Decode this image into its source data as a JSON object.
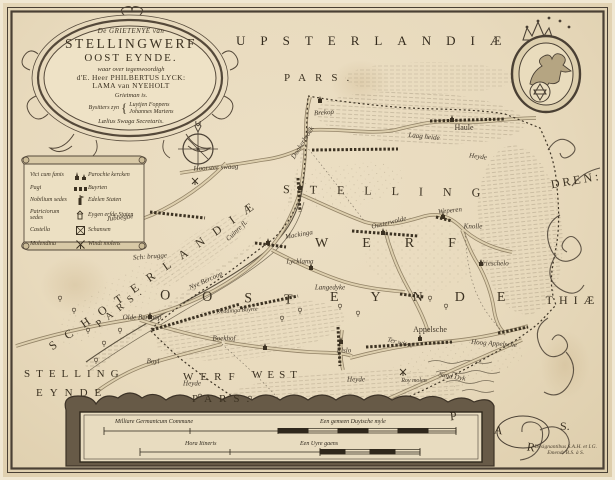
{
  "title_cartouche": {
    "line1": "De GRIETENYE van",
    "line2": "STELLINGWERF",
    "line3": "OOST EYNDE.",
    "line4": "waar over tegenwoordigh",
    "line5": "d'E. Heer PHILBERTUS LYCK:",
    "line6": "LAMA van NYEHOLT",
    "line7": "Grietman is.",
    "bysitters_label": "Bysitters zyn",
    "brace": "{",
    "bysitter1": "Luytjen Foppens",
    "bysitter2": "Johannes Martens",
    "line9": "Lælius Swaga Secretaris."
  },
  "neighbour_labels": {
    "upsterlandiae": "UPSTERLANDIÆ",
    "upsterlandiae_pars": "PARS.",
    "schoterlandiae": "SCHOTERLANDIÆ",
    "schoterlandiae_pars": "PARS.",
    "drenthiae_part1": "DREN:",
    "drenthiae_part2": "THIÆ",
    "pars_letters": [
      "P",
      "A",
      "R",
      "S."
    ],
    "west_stelling": "STELLING",
    "west_werf": "WERF",
    "west_west": "WEST",
    "west_eynde": "EYNDE",
    "west_pars": "PARS."
  },
  "region_labels": {
    "stelling": "STELLING",
    "werf": "WERF",
    "oost": "OOST",
    "eynde": "EYNDE"
  },
  "legend": {
    "rows": [
      {
        "latin": "Vici cum fanis",
        "dutch": "Parochie kercken",
        "icon": "church-pair-icon"
      },
      {
        "latin": "Pagi",
        "dutch": "Buyrten",
        "icon": "hamlet-icon"
      },
      {
        "latin": "Nobilium sedes",
        "dutch": "Edelen Staten",
        "icon": "noble-seat-icon"
      },
      {
        "latin": "Patriciorum sedes",
        "dutch": "Eygen erfde Staten",
        "icon": "patrician-seat-icon"
      },
      {
        "latin": "Castella",
        "dutch": "Schansen",
        "icon": "fort-icon"
      },
      {
        "latin": "Molendina",
        "dutch": "Windt molens",
        "icon": "windmill-icon"
      }
    ]
  },
  "scale_cartouche": {
    "bar1_label_left": "Milliare Germanicum Commune",
    "bar1_label_right": "Een gemeen Duytsche myle",
    "bar2_label_left": "Hora Itineris",
    "bar2_label_right": "Een Uyre gaens"
  },
  "signature": {
    "line1": "Designantibus S.A.H. et I.G.",
    "line2": "Emend: B.S. à S."
  },
  "colors": {
    "paper": "#e8dabd",
    "ink": "#3c3222",
    "road": "#d8cba8",
    "hatch": "#6b5e46"
  },
  "places": [
    {
      "name": "Jubbegae",
      "x": 120,
      "y": 218,
      "rot": -6
    },
    {
      "name": "Sch: brugge",
      "x": 150,
      "y": 257,
      "rot": -4
    },
    {
      "name": "Hoorster swaag",
      "x": 216,
      "y": 168,
      "rot": -3
    },
    {
      "name": "Brekop",
      "x": 324,
      "y": 113,
      "rot": -4
    },
    {
      "name": "Haule",
      "x": 464,
      "y": 128,
      "rot": 0,
      "cls": "pl-md"
    },
    {
      "name": "Laag heide",
      "x": 424,
      "y": 137,
      "rot": 6
    },
    {
      "name": "Heyde",
      "x": 478,
      "y": 157,
      "rot": 8
    },
    {
      "name": "Donkerbroek",
      "x": 303,
      "y": 143,
      "rot": -58
    },
    {
      "name": "Weperen",
      "x": 450,
      "y": 211,
      "rot": -6
    },
    {
      "name": "Knolle",
      "x": 473,
      "y": 227,
      "rot": 0
    },
    {
      "name": "Mackinga",
      "x": 299,
      "y": 235,
      "rot": -10
    },
    {
      "name": "Ousterwolde",
      "x": 389,
      "y": 223,
      "rot": -14
    },
    {
      "name": "Lycklama",
      "x": 300,
      "y": 262,
      "rot": 0
    },
    {
      "name": "Nye Bercoop",
      "x": 206,
      "y": 281,
      "rot": -24
    },
    {
      "name": "Olde Bercoop",
      "x": 142,
      "y": 318,
      "rot": 0
    },
    {
      "name": "Deddinga Buyrte",
      "x": 237,
      "y": 311,
      "rot": -4,
      "cls": "pl-xs"
    },
    {
      "name": "Langedyke",
      "x": 330,
      "y": 288,
      "rot": 0
    },
    {
      "name": "Vrieschelo",
      "x": 494,
      "y": 264,
      "rot": 0
    },
    {
      "name": "Boekhof",
      "x": 224,
      "y": 339,
      "rot": 0
    },
    {
      "name": "Boyl",
      "x": 153,
      "y": 362,
      "rot": 0
    },
    {
      "name": "Elslo",
      "x": 344,
      "y": 351,
      "rot": 0
    },
    {
      "name": "Appelsche",
      "x": 430,
      "y": 330,
      "rot": 0,
      "cls": "pl-md"
    },
    {
      "name": "Hoog Appelsche",
      "x": 494,
      "y": 344,
      "rot": 4
    },
    {
      "name": "Ter wisse",
      "x": 400,
      "y": 343,
      "rot": 14
    },
    {
      "name": "Sand Dyk",
      "x": 452,
      "y": 377,
      "rot": 10
    },
    {
      "name": "Roy molen",
      "x": 414,
      "y": 381,
      "rot": 0,
      "cls": "pl-xs"
    },
    {
      "name": "Heyde",
      "x": 192,
      "y": 384,
      "rot": 0
    },
    {
      "name": "Heyde",
      "x": 356,
      "y": 380,
      "rot": 0
    },
    {
      "name": "Cuinre fl.",
      "x": 237,
      "y": 231,
      "rot": -44
    }
  ]
}
